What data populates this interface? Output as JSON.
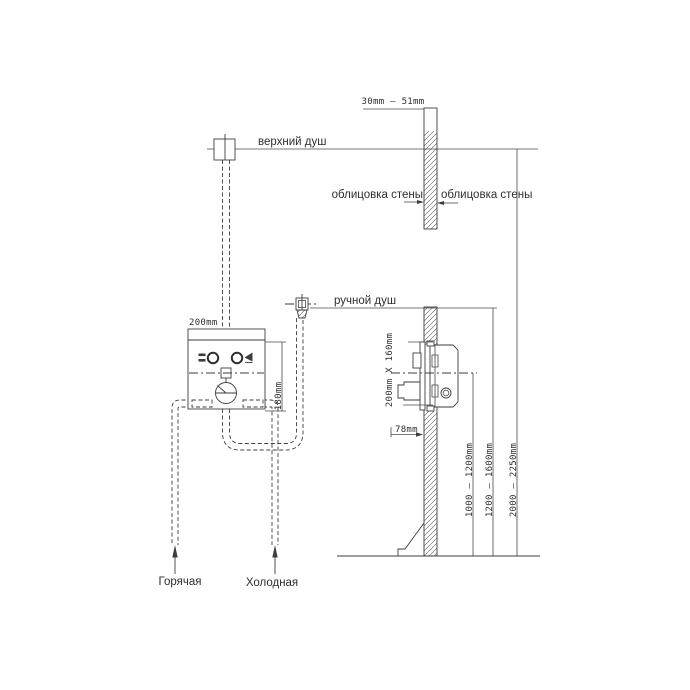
{
  "drawing": {
    "title_meaning": "concealed shower mixer installation diagram",
    "line_color": "#3d3d3d",
    "background_color": "#ffffff",
    "labels": {
      "top_shower": "верхний душ",
      "hand_shower": "ручной душ",
      "wall_cladding_left": "облицовка стены",
      "wall_cladding_right": "облицовка стены",
      "hot_supply": "Горячая",
      "cold_supply": "Холодная"
    },
    "dimensions": {
      "cladding_gap": "30mm  –  51mm",
      "mixer_box_width": "200mm",
      "mixer_box_height": "180mm",
      "recess_opening": "200mm X 160mm",
      "recess_depth": "78mm",
      "mixer_height_range": "1000 – 1200mm",
      "hand_shower_height_range": "1200 – 1600mm",
      "top_shower_height_range": "2000 – 2250mm"
    }
  }
}
